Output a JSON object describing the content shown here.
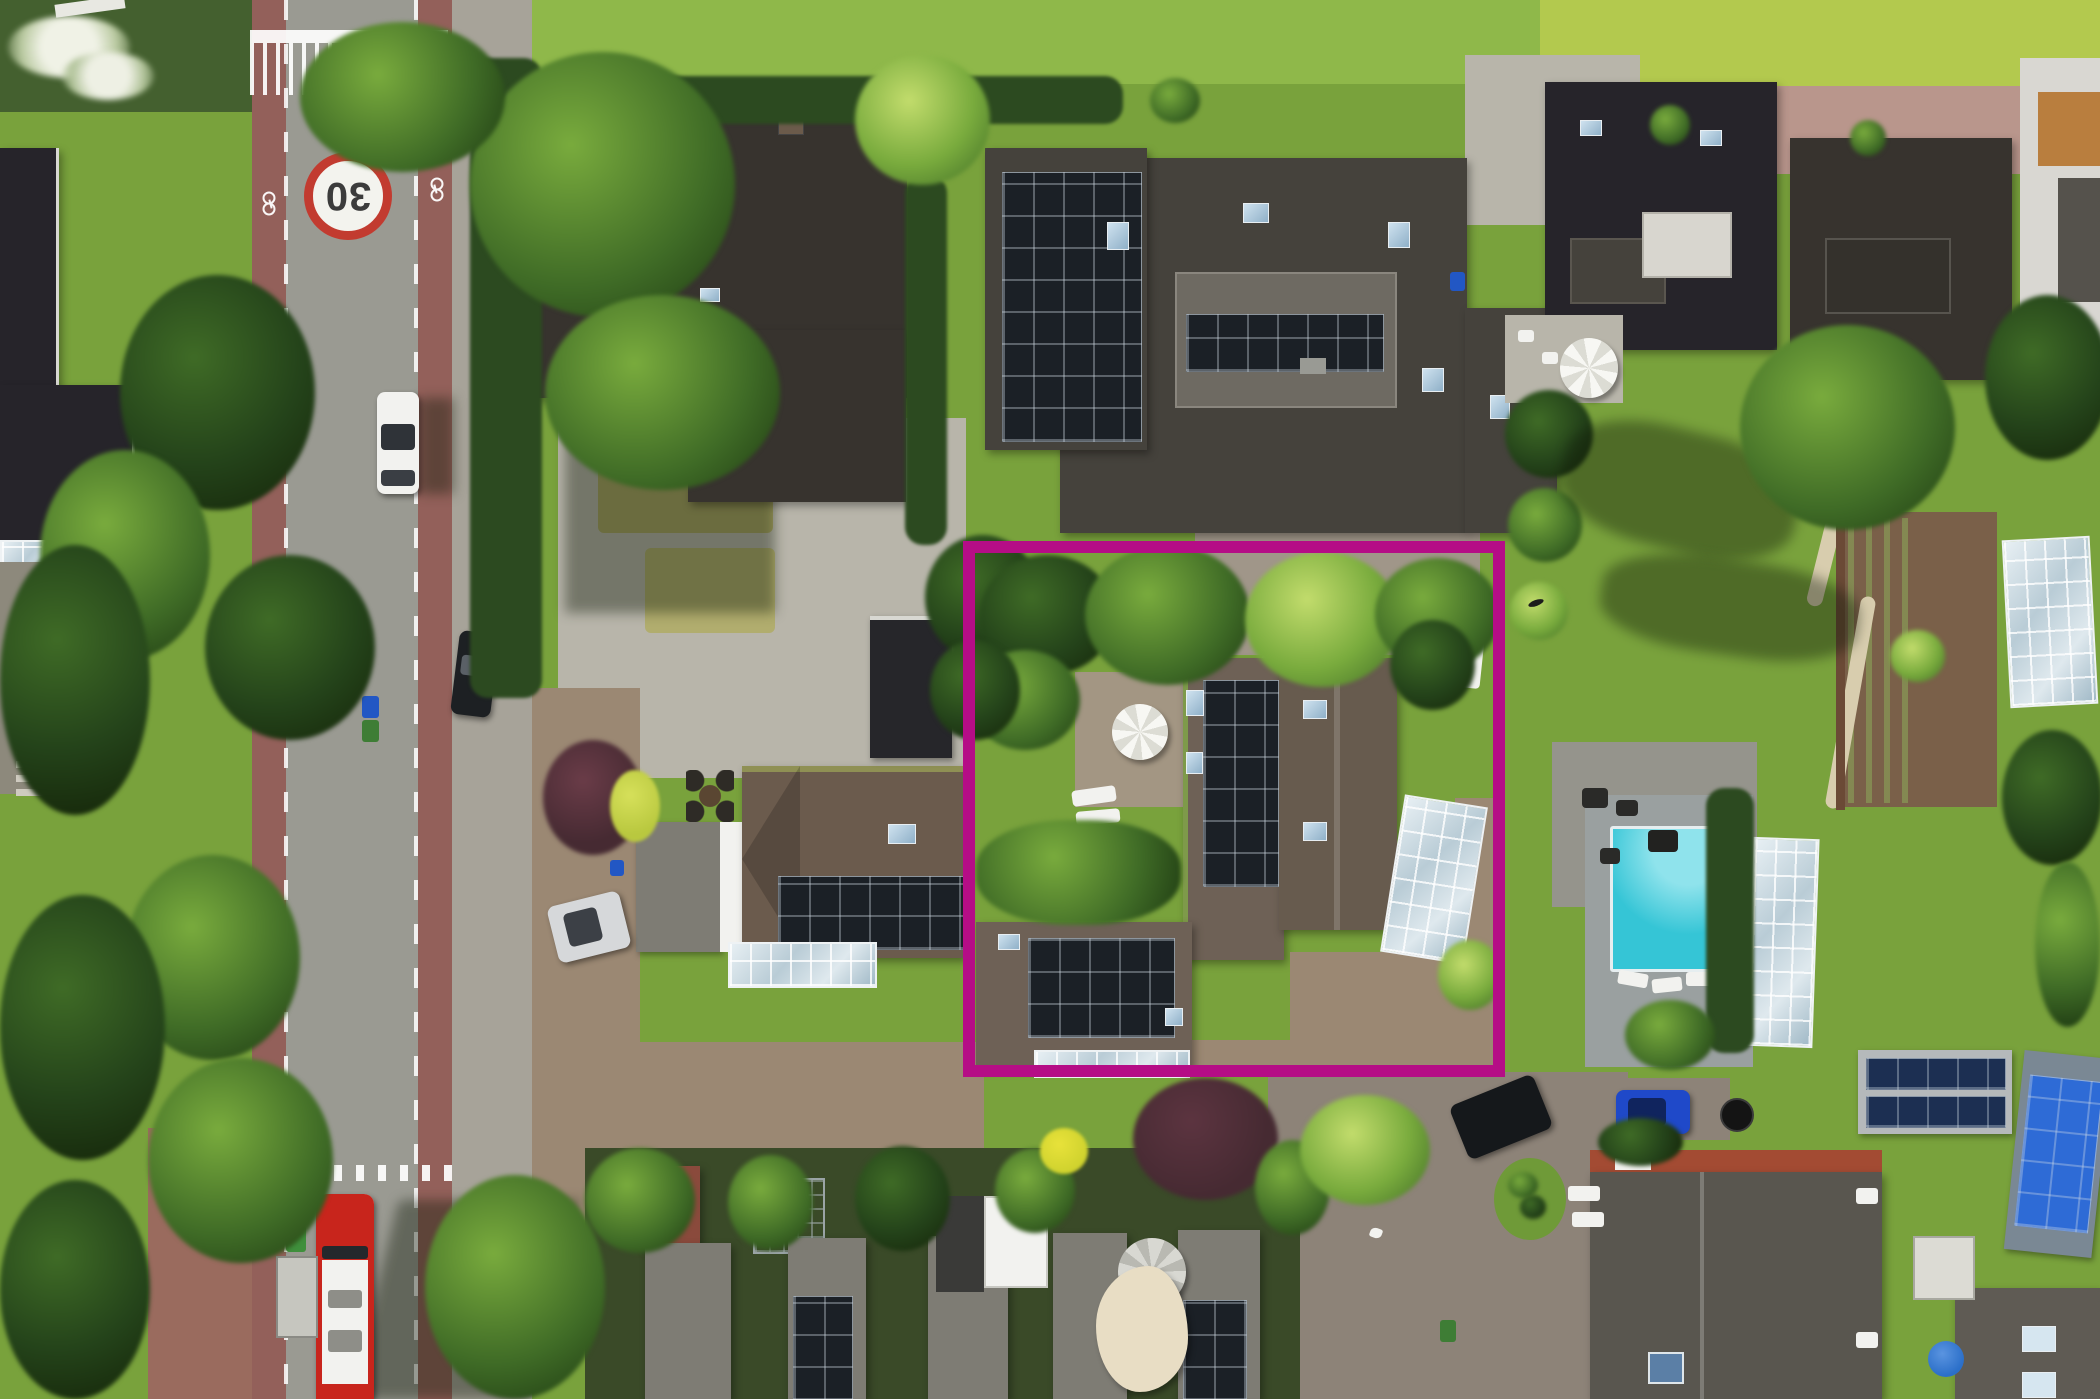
{
  "scene": {
    "type": "aerial-drone-photograph",
    "description": "Top-down drone view of a leafy suburban neighborhood: a vertical street with red cycle lanes and a painted 30 zone roundel on the left, detached villas with dark tiled roofs and rooftop solar panels, lush gardens and hedges, a turquoise swimming pool, glass conservatories and greenhouses, a vegetable garden, parked cars, a red-and-white bus at a bus shelter, and a terraced-house row at the bottom. A magenta rectangle highlights the central property.",
    "highlighted_property": "Villa with brown tiled roofs, rooftop solar panels, white garden parasol, glass veranda, glass pool cover and gravel driveway"
  },
  "annotation": {
    "highlight_box": {
      "left": 963,
      "top": 541,
      "width": 542,
      "height": 536,
      "border_width": 12,
      "color": "#b50d86"
    }
  },
  "road": {
    "speed_limit_marking": "30",
    "markings": [
      "give-way comb bar",
      "dashed edge lines",
      "red cycle lanes with bicycle symbols",
      "shark-teeth give-way dashes",
      "bus stop with shelter"
    ]
  },
  "vehicles": {
    "white_car": {
      "color": "#f1f1ef",
      "location": "driving on street"
    },
    "silver_car": {
      "color": "#d6d8da",
      "location": "parked on neighbor driveway"
    },
    "black_car_driveway": {
      "color": "#1d2023",
      "location": "parked at driveway entrance"
    },
    "black_car_courtyard": {
      "color": "#15181b",
      "location": "parked under trees, rear courtyard"
    },
    "blue_car": {
      "color": "#1f49c9",
      "location": "parked in rear courtyard"
    },
    "bus": {
      "colors": [
        "#c8251c",
        "#f2f2ef"
      ],
      "location": "bus stop, bottom left"
    }
  },
  "site_features": {
    "swimming_pool_color": "#35c5d6",
    "solar_panel_color": "#1b2026",
    "bright_solar_panel_color": "#2e6bd6",
    "glass_structures": [
      "conservatory",
      "greenhouse",
      "pool cover",
      "atrium",
      "veranda"
    ],
    "parasols": [
      "white parasol in highlighted garden",
      "white parasol top right",
      "grey parasol bottom terrace",
      "blue parasol bottom right"
    ],
    "vegetable_garden": "brown soil plot with planted rows, right side",
    "canal_water_top": "#b3c94e"
  },
  "colors": {
    "grass": "#79a23c",
    "grassLight": "#8fb84a",
    "algae": "#b3c94e",
    "waterDark": "#44602f",
    "treeDark": "#24431a",
    "treeMid": "#3f6b26",
    "treeLight": "#79ab3d",
    "hedge": "#2c4a20",
    "asphalt": "#9a9a92",
    "cycleLane": "#93605a",
    "sidewalk": "#a7a399",
    "paveLight": "#b8b5aa",
    "gravel": "#9b8873",
    "gravelCool": "#8d8378",
    "brickWalk": "#b9968c",
    "brickRed": "#9a6b5e",
    "dryLawn": "#a8a464",
    "roofBlack": "#26242a",
    "roofDark": "#37332e",
    "roofDarkGray": "#45423c",
    "roofBrown": "#6b5b4d",
    "roofBrown2": "#6e6156",
    "roofHip": "#675b4e",
    "corrugated": "#7e7c74",
    "roofLight": "#6e6a62",
    "roofGray": "#59564f",
    "ridgeRed": "#a34b33",
    "redRoof": "#8a4a3c",
    "white": "#f2f2ef",
    "cream": "#e8ddc4",
    "glassFrame": "#eef2f4",
    "solar": "#1b2026",
    "solarBlue": "#2e6bd6",
    "skylight": "#a9c6dd",
    "pool": "#35c5d6",
    "poolLight": "#8fe3ec",
    "busRed": "#c8251c",
    "carBlue": "#1f49c9",
    "carSilver": "#d6d8da",
    "carBlack": "#1d2023",
    "soil": "#7a6049",
    "pathTan": "#d8cdae",
    "purpleTree": "#462a32",
    "yellowBush": "#b9c83f",
    "ringRed": "#c23b30",
    "mossRidge": "#8f9054",
    "highlight": "#b50d86"
  }
}
